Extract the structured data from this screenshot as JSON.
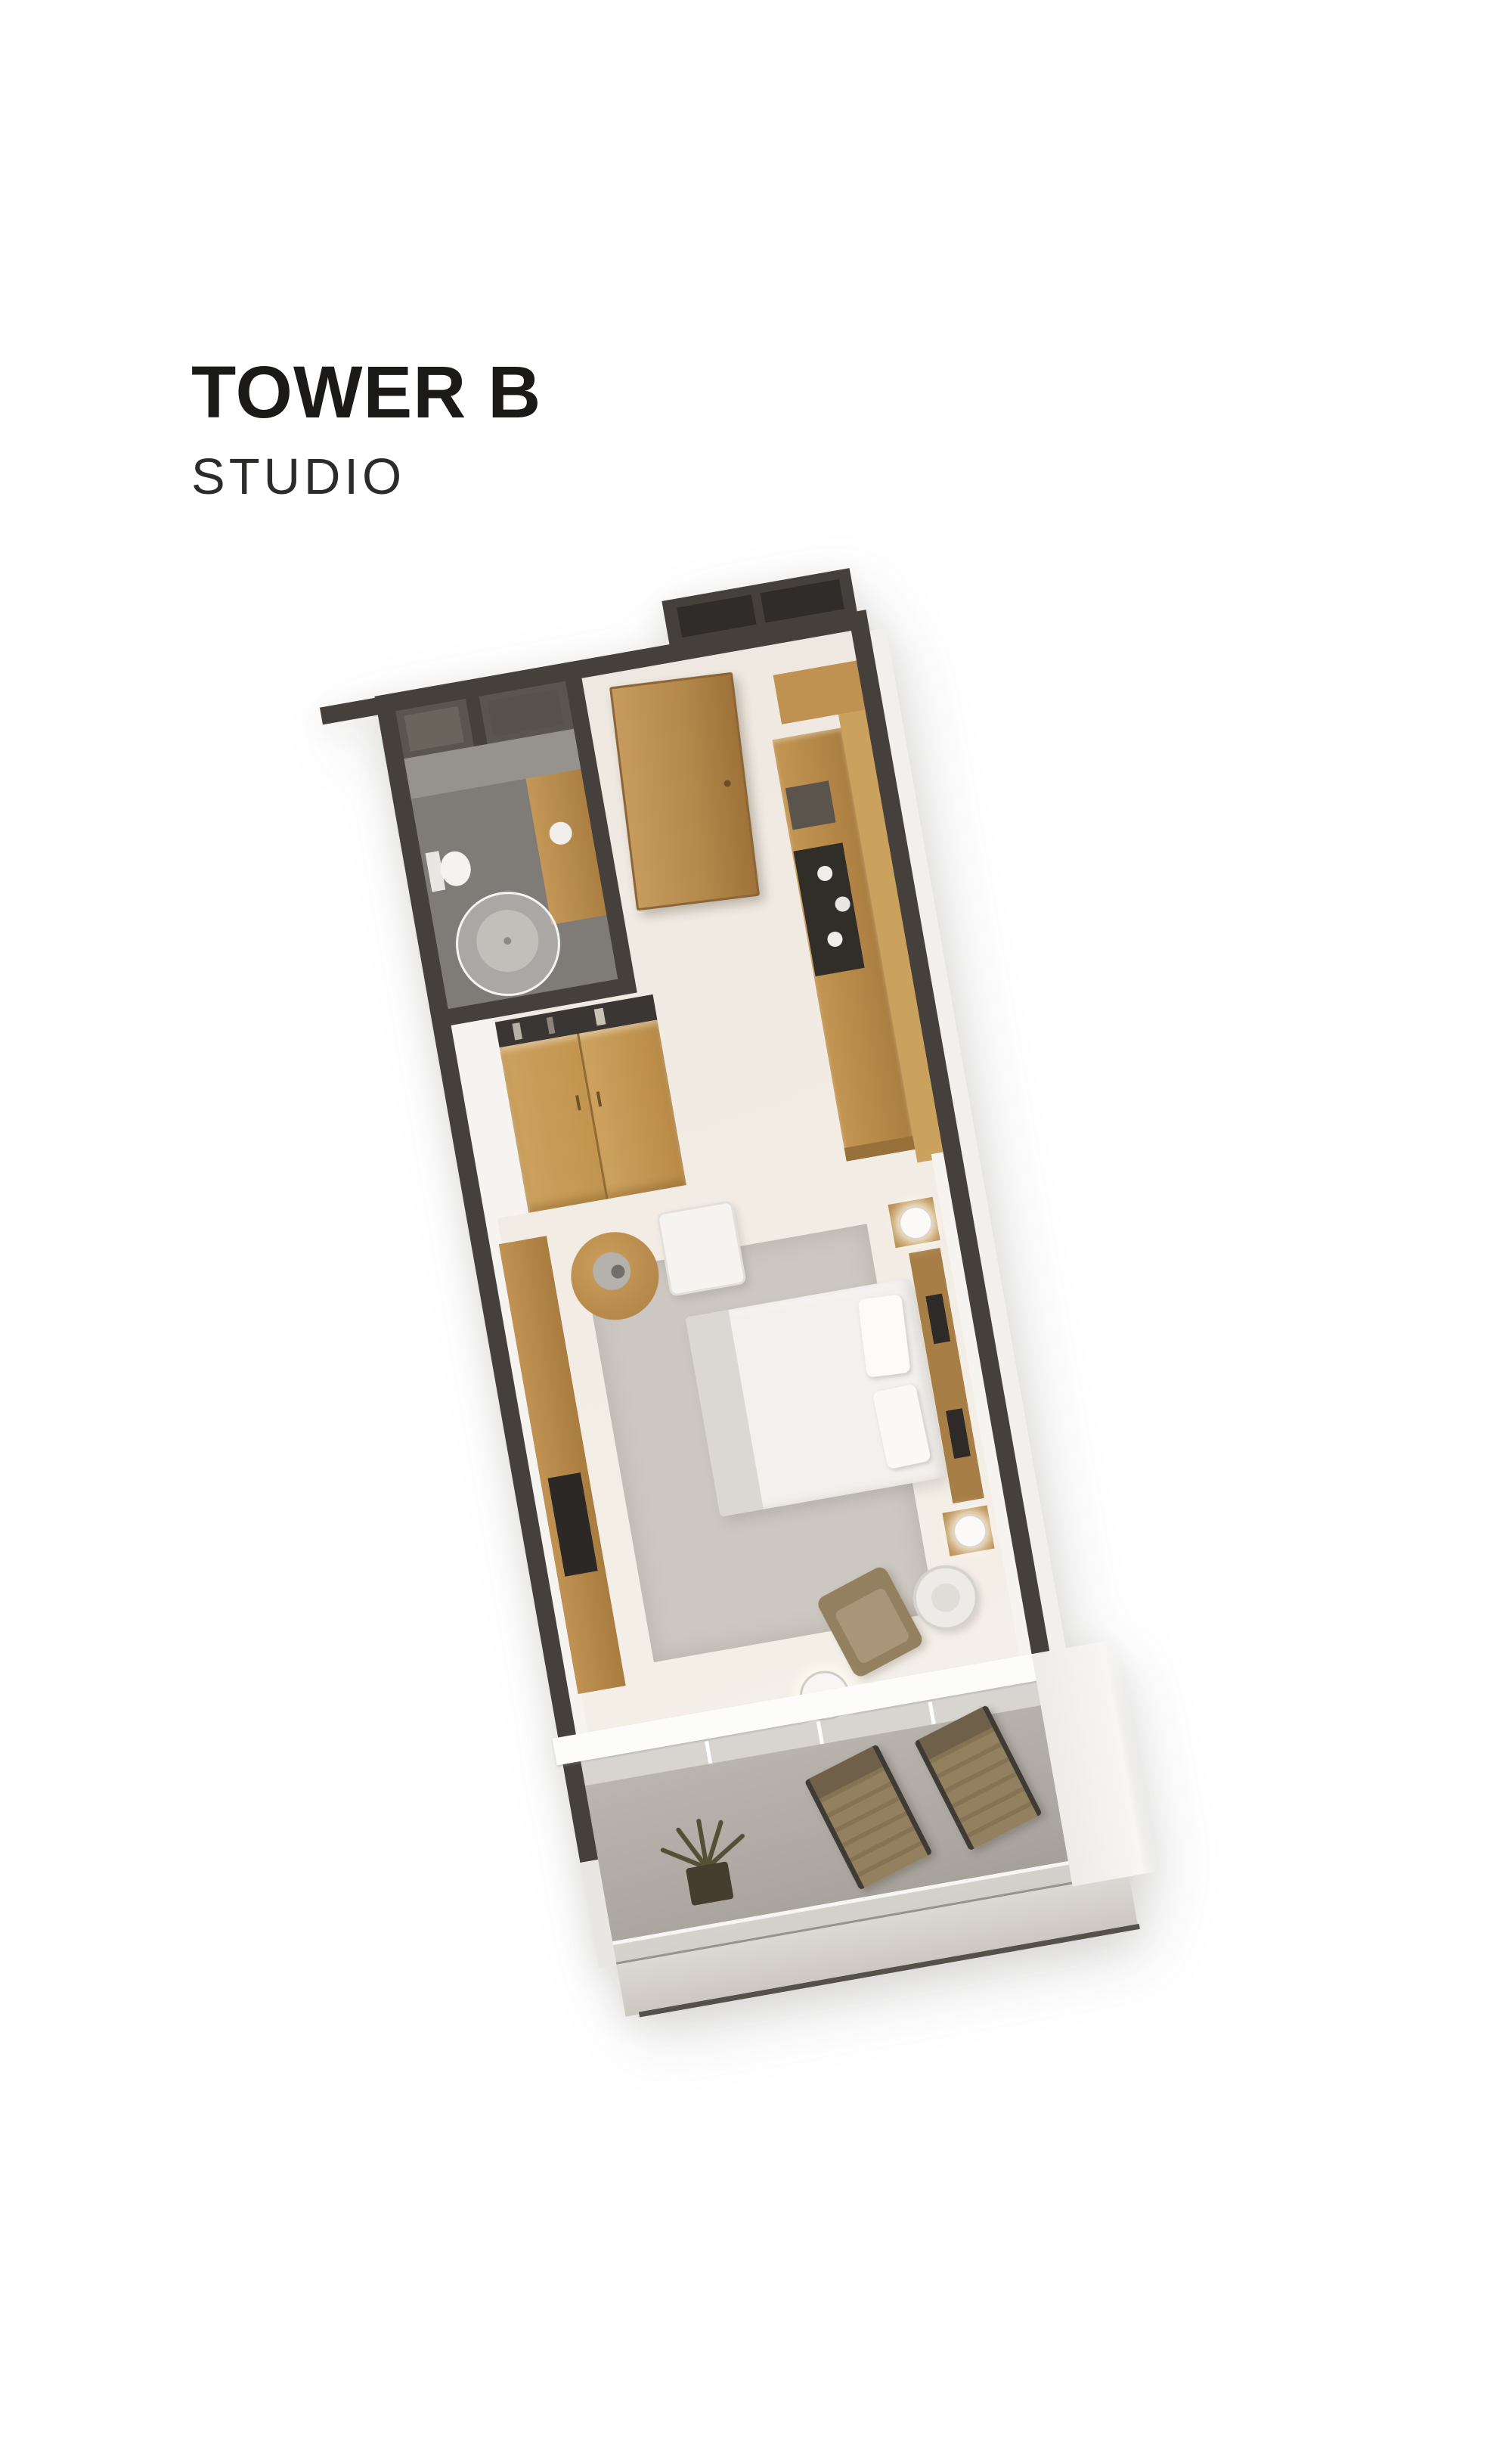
{
  "header": {
    "title": "TOWER B",
    "subtitle": "STUDIO"
  },
  "colors": {
    "text": "#1c1a18",
    "wall": "#45403c",
    "wall_dark": "#2f2c29",
    "shaft": "#5a5550",
    "floor": "#f0e9e1",
    "bath_floor": "#7f7c78",
    "wood": "#b78a4a",
    "wood_light": "#cba15e",
    "wood_deep": "#a87e47",
    "rug": "#ccc7c1",
    "white_wall": "#f6f4f1",
    "balcony_floor": "#b2ada7",
    "ledge": "#d8d4cf",
    "chair": "#93805f",
    "chair_frame": "#3f3a33",
    "plant": "#525036",
    "dark_item": "#2b2825"
  },
  "floorplan": {
    "view": "3d-isometric-floor-plan",
    "rooms": [
      "bathroom",
      "entry-hall",
      "kitchen",
      "wardrobe",
      "bedroom",
      "balcony"
    ]
  }
}
